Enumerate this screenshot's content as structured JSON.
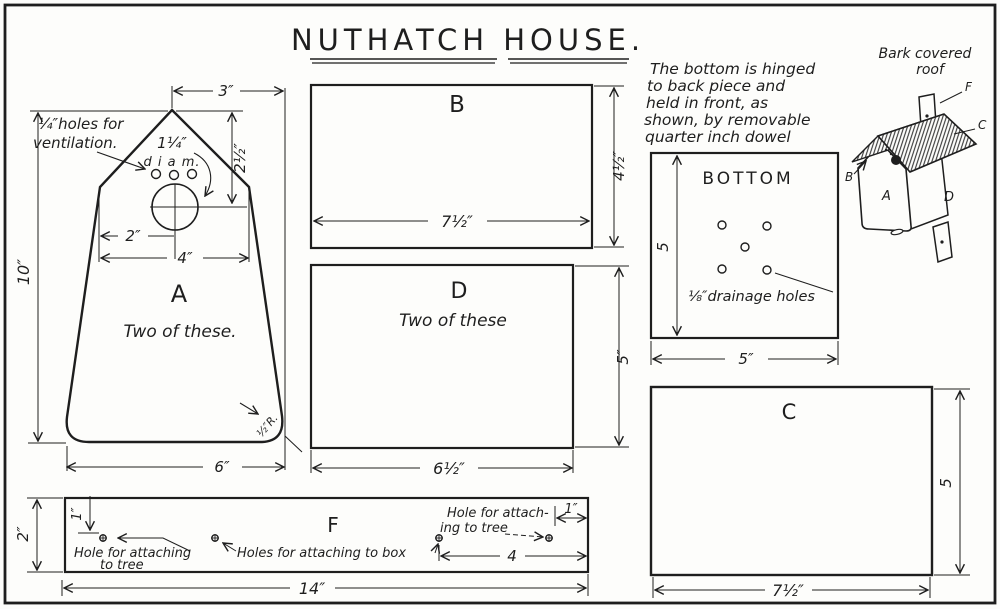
{
  "title": "NUTHATCH HOUSE.",
  "assembly_note": {
    "l1": "The bottom is hinged",
    "l2": "to back piece and",
    "l3": "held in front, as",
    "l4": "shown, by removable",
    "l5": "quarter inch dowel"
  },
  "piece_a": {
    "label": "A",
    "qty": "Two of these.",
    "vent1": "¼″holes for",
    "vent2": "ventilation.",
    "hole1": "1¼″",
    "hole2": "d i a m.",
    "corner": "½″R.",
    "dim_top": "3″",
    "dim_peak": "2½″",
    "dim_two": "2″",
    "dim_four": "4″",
    "dim_height": "10″",
    "dim_bottom": "6″"
  },
  "piece_b": {
    "label": "B",
    "dim_w": "7½″",
    "dim_h": "4½″"
  },
  "piece_d": {
    "label": "D",
    "qty": "Two of these",
    "dim_w": "6½″",
    "dim_h": "5″"
  },
  "bottom_piece": {
    "label": "BOTTOM",
    "drain": "⅛″drainage holes",
    "dim_w": "5″",
    "dim_h": "5"
  },
  "piece_c": {
    "label": "C",
    "dim_w": "7½″",
    "dim_h": "5"
  },
  "piece_f": {
    "label": "F",
    "dim_h": "2″",
    "dim_one_left": "1″",
    "dim_one_right": "1″",
    "dim_four": "4",
    "dim_len": "14″",
    "note_left1": "Hole for attaching",
    "note_left2": "to tree",
    "note_mid": "Holes for attaching to box",
    "note_right1": "Hole for attach-",
    "note_right2": "ing to tree"
  },
  "iso": {
    "cap1": "Bark covered",
    "cap2": "roof",
    "f": "F",
    "c": "C",
    "b": "B",
    "a": "A",
    "d": "D"
  }
}
